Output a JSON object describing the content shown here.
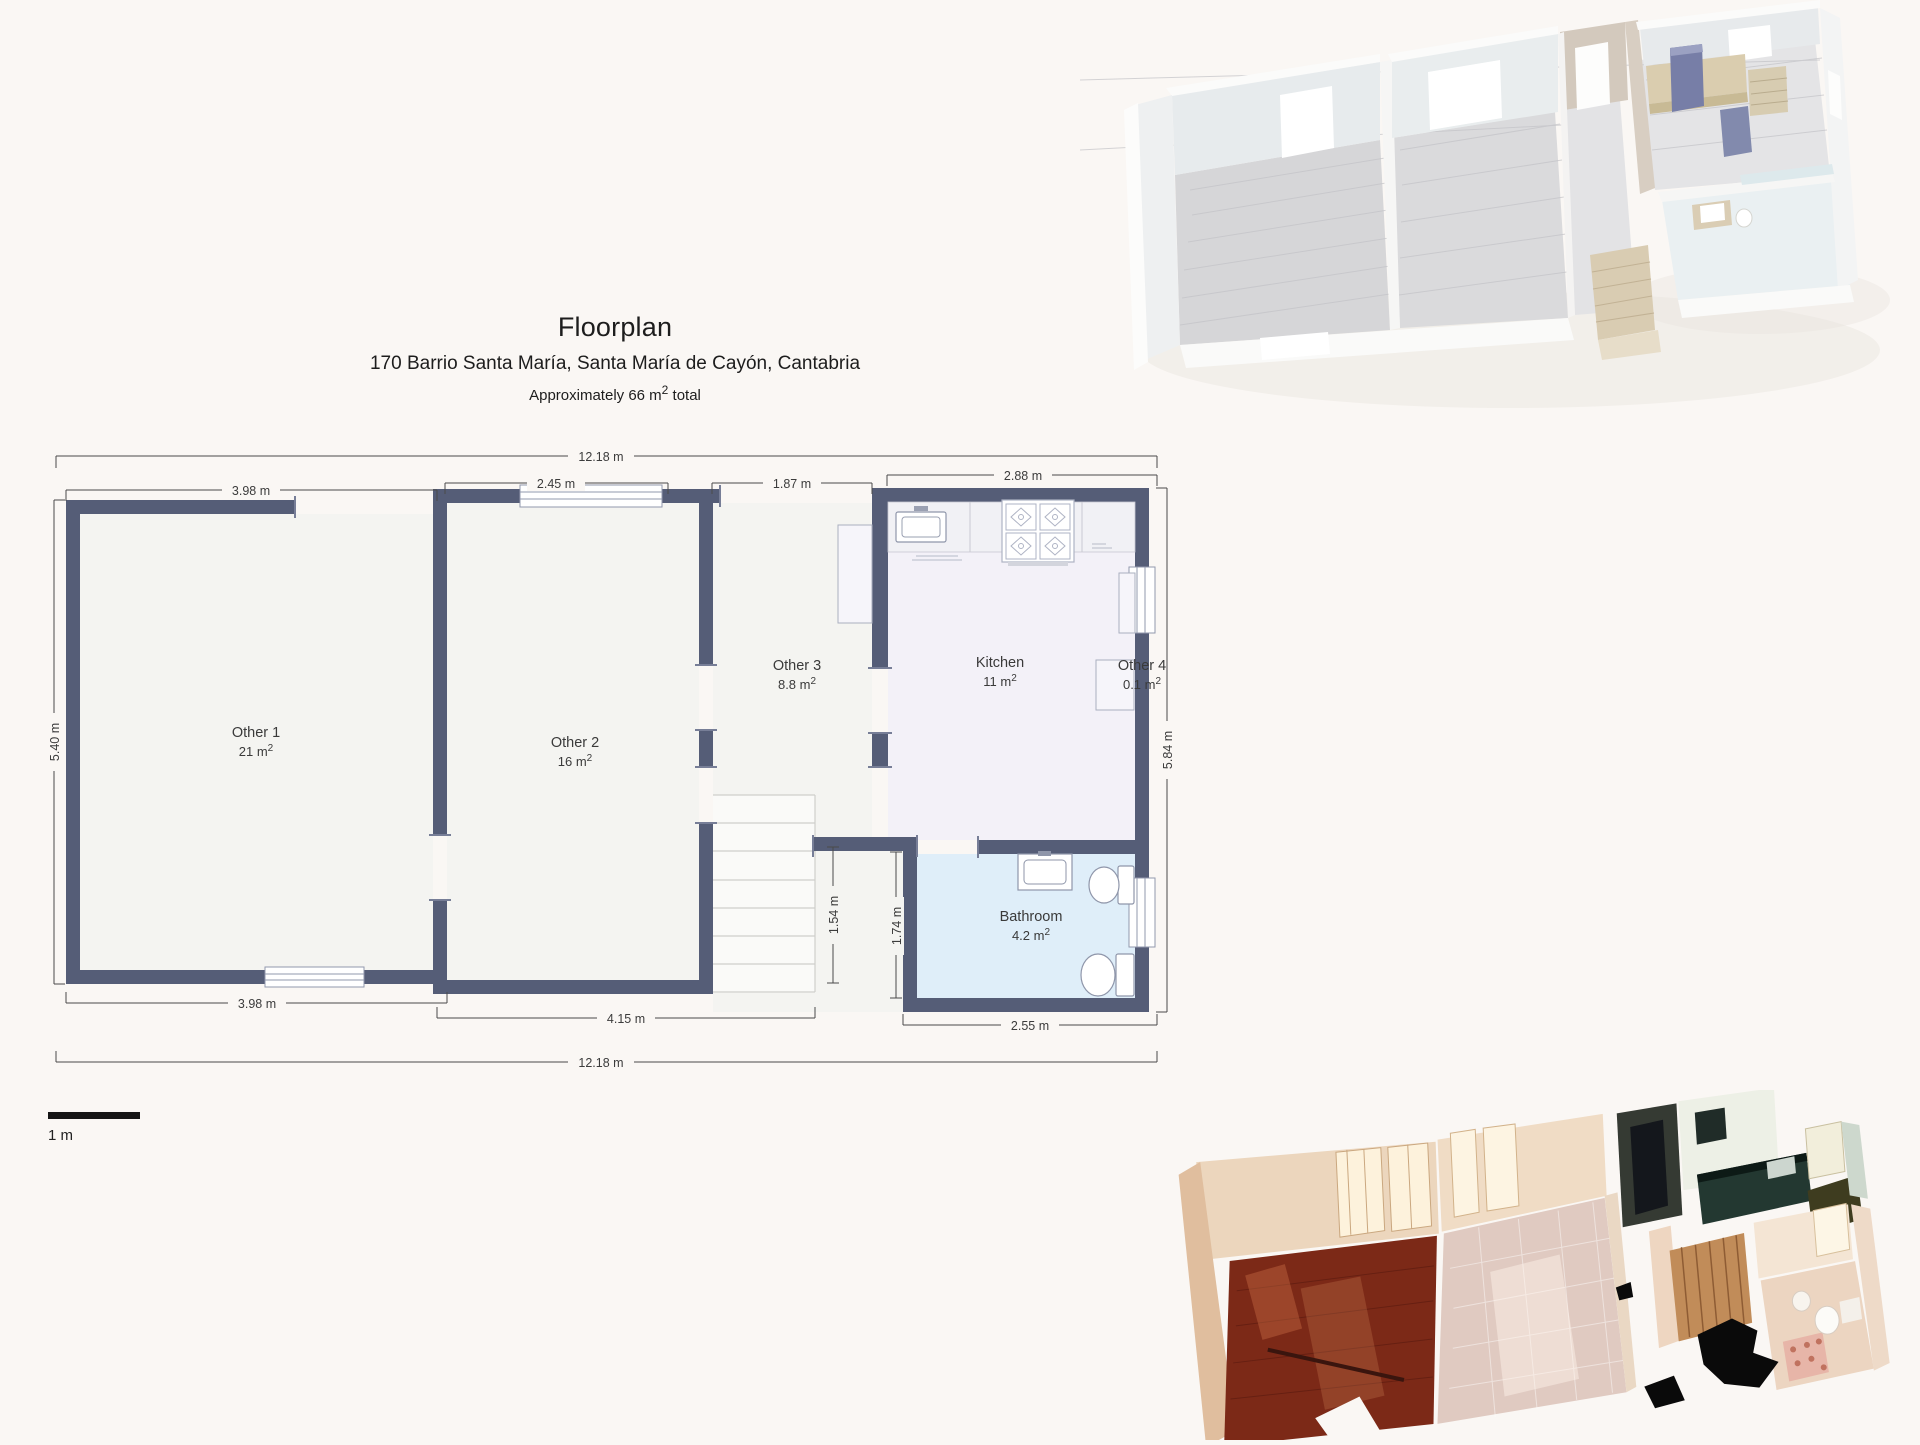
{
  "page": {
    "background": "#faf7f4"
  },
  "header": {
    "title": "Floorplan",
    "address": "170 Barrio Santa María, Santa María de Cayón, Cantabria",
    "area_prefix": "Approximately 66 m",
    "area_sup": "2",
    "area_suffix": " total"
  },
  "floorplan": {
    "sup": "2",
    "scale_label": "1 m",
    "colors": {
      "wall": "#555d77",
      "room_fill": "#f4f4f1",
      "kitchen_fill": "#f3f1f8",
      "bathroom_fill": "#dfeef9",
      "stairs_fill": "#fafaf8"
    },
    "rooms": [
      {
        "name": "Other 1",
        "area": "21 m"
      },
      {
        "name": "Other 2",
        "area": "16 m"
      },
      {
        "name": "Other 3",
        "area": "8.8 m"
      },
      {
        "name": "Kitchen",
        "area": "11 m"
      },
      {
        "name": "Other 4",
        "area": "0.1 m"
      },
      {
        "name": "Bathroom",
        "area": "4.2 m"
      }
    ],
    "dimensions": {
      "top_total": "12.18 m",
      "top_other1": "3.98 m",
      "top_other2": "2.45 m",
      "top_corridor": "1.87 m",
      "top_kitchen": "2.88 m",
      "left_other1": "5.40 m",
      "right_kitchen": "5.84 m",
      "stair_opening": "1.54 m",
      "bathroom_height": "1.74 m",
      "bottom_other1": "3.98 m",
      "bottom_other2": "4.15 m",
      "bottom_bathroom": "2.55 m",
      "bottom_total": "12.18 m"
    }
  }
}
